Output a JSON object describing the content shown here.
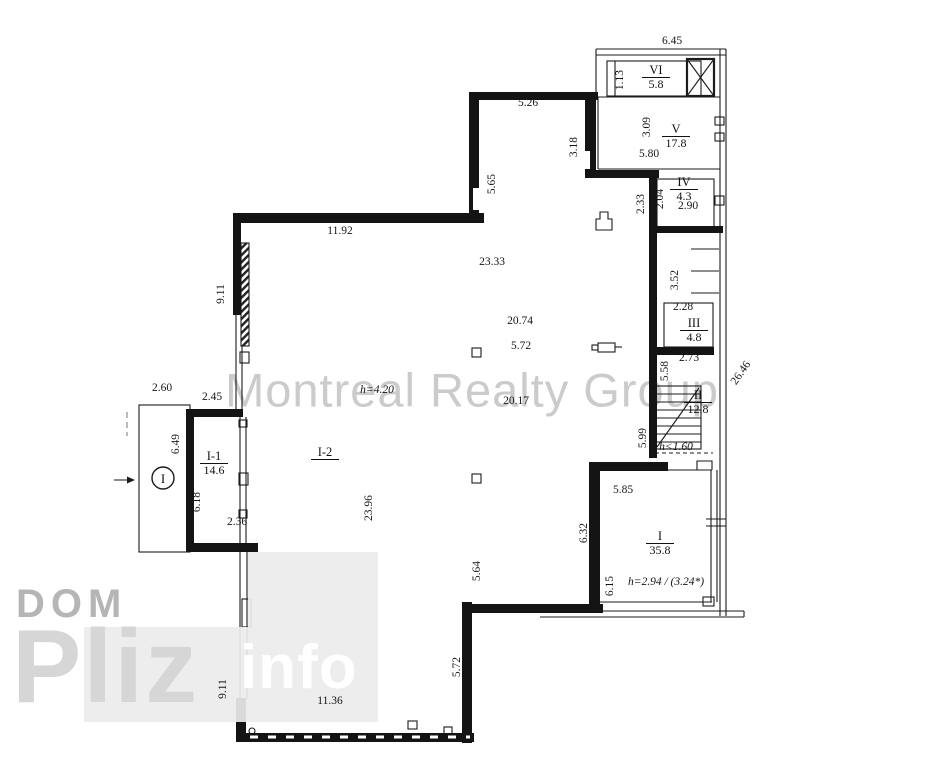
{
  "title": "Apartment floor plan",
  "watermarks": {
    "center": "Montreal Realty Group",
    "logo_line1": "DOM",
    "logo_line2": "Pliz",
    "logo_line3": "info"
  },
  "colors": {
    "wall": "#141414",
    "line": "#1b1b1b",
    "watermark_center": "#c2c2c2",
    "logo_gray": "#b5b5b5",
    "logo_pliz": "#d6d6d6",
    "logo_block": "#ececec"
  },
  "rooms": [
    {
      "label": "VI",
      "area": "5.8",
      "x": 656,
      "y": 64
    },
    {
      "label": "V",
      "area": "17.8",
      "x": 676,
      "y": 123
    },
    {
      "label": "IV",
      "area": "4.3",
      "x": 684,
      "y": 176
    },
    {
      "label": "III",
      "area": "4.8",
      "x": 694,
      "y": 317
    },
    {
      "label": "II",
      "area": "12.8",
      "x": 698,
      "y": 389
    },
    {
      "label": "I",
      "area": "35.8",
      "x": 660,
      "y": 530
    },
    {
      "label": "I-1",
      "area": "14.6",
      "x": 214,
      "y": 450
    },
    {
      "label": "I-2",
      "area": "",
      "x": 325,
      "y": 446
    }
  ],
  "dimensions": [
    {
      "text": "6.45",
      "x": 672,
      "y": 41
    },
    {
      "text": "1.13",
      "x": 620,
      "y": 80,
      "rot": -90
    },
    {
      "text": "5.26",
      "x": 528,
      "y": 103
    },
    {
      "text": "3.09",
      "x": 647,
      "y": 127,
      "rot": -90
    },
    {
      "text": "3.18",
      "x": 574,
      "y": 147,
      "rot": -90
    },
    {
      "text": "5.80",
      "x": 649,
      "y": 154
    },
    {
      "text": "3.47",
      "x": 612,
      "y": 175
    },
    {
      "text": "5.65",
      "x": 492,
      "y": 184,
      "rot": -90
    },
    {
      "text": "2.04",
      "x": 660,
      "y": 199,
      "rot": -90
    },
    {
      "text": "2.33",
      "x": 641,
      "y": 204,
      "rot": -90
    },
    {
      "text": "2.90",
      "x": 688,
      "y": 206
    },
    {
      "text": "11.92",
      "x": 340,
      "y": 231
    },
    {
      "text": "23.33",
      "x": 492,
      "y": 262
    },
    {
      "text": "3.52",
      "x": 675,
      "y": 280,
      "rot": -90
    },
    {
      "text": "9.11",
      "x": 221,
      "y": 294,
      "rot": -90
    },
    {
      "text": "2.28",
      "x": 683,
      "y": 307
    },
    {
      "text": "20.74",
      "x": 520,
      "y": 321
    },
    {
      "text": "2.30",
      "x": 654,
      "y": 327,
      "rot": -90
    },
    {
      "text": "5.72",
      "x": 521,
      "y": 346
    },
    {
      "text": "2.73",
      "x": 689,
      "y": 358
    },
    {
      "text": "5.58",
      "x": 665,
      "y": 371,
      "rot": -90
    },
    {
      "text": "26.46",
      "x": 741,
      "y": 373,
      "rot": -55
    },
    {
      "text": "2.60",
      "x": 162,
      "y": 388
    },
    {
      "text": "h=4.20",
      "x": 377,
      "y": 390,
      "style": "italic"
    },
    {
      "text": "2.45",
      "x": 212,
      "y": 397
    },
    {
      "text": "20.17",
      "x": 516,
      "y": 401
    },
    {
      "text": "5.99",
      "x": 643,
      "y": 438,
      "rot": -90
    },
    {
      "text": "6.49",
      "x": 176,
      "y": 444,
      "rot": -90
    },
    {
      "text": "h<1.60",
      "x": 676,
      "y": 447,
      "style": "italic"
    },
    {
      "text": "5.85",
      "x": 623,
      "y": 490
    },
    {
      "text": "6.18",
      "x": 197,
      "y": 502,
      "rot": -90
    },
    {
      "text": "23.96",
      "x": 369,
      "y": 508,
      "rot": -90
    },
    {
      "text": "2.36",
      "x": 237,
      "y": 522
    },
    {
      "text": "6.32",
      "x": 584,
      "y": 533,
      "rot": -90
    },
    {
      "text": "5.64",
      "x": 477,
      "y": 571,
      "rot": -90
    },
    {
      "text": "h=2.94 / (3.24*)",
      "x": 666,
      "y": 582,
      "style": "italic"
    },
    {
      "text": "6.15",
      "x": 610,
      "y": 586,
      "rot": -90
    },
    {
      "text": "5.72",
      "x": 457,
      "y": 667,
      "rot": -90
    },
    {
      "text": "9.11",
      "x": 223,
      "y": 689,
      "rot": -90
    },
    {
      "text": "11.36",
      "x": 330,
      "y": 701
    }
  ],
  "symbols": [
    "circled-I-entry-marker",
    "ventilation-shaft-x",
    "staircase",
    "window-hatch",
    "direction-arrow"
  ]
}
